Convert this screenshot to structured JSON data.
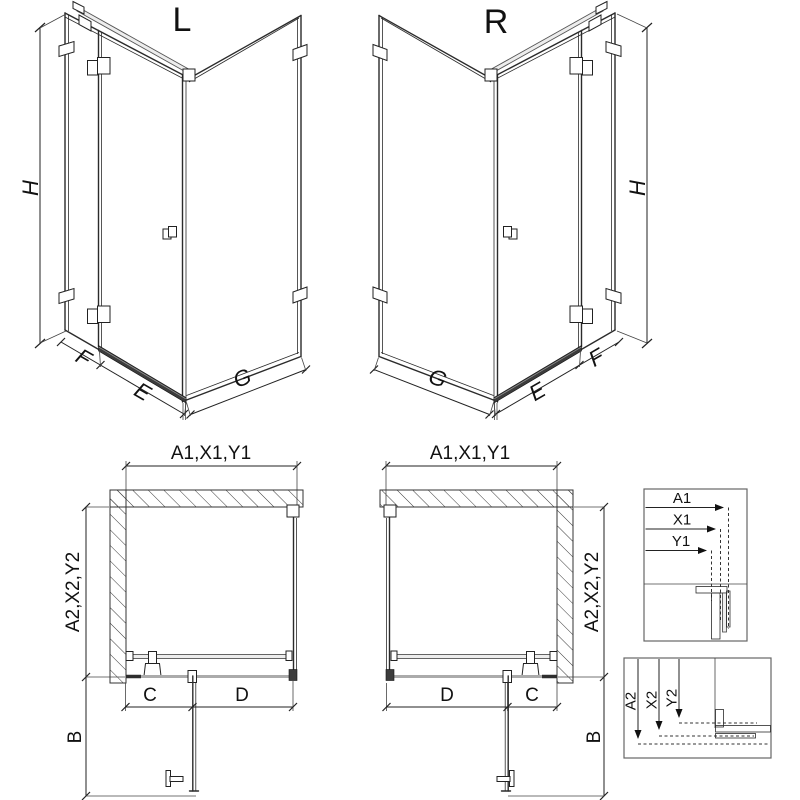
{
  "colors": {
    "background": "#ffffff",
    "line": "#2b2b2b",
    "dimension": "#222222",
    "sill_gray": "#ababab",
    "hardware_dark": "#3c3c3c"
  },
  "iso_left": {
    "title": "L",
    "height_label": "H",
    "panel_label": "F",
    "door_label": "E",
    "side_label": "G"
  },
  "iso_right": {
    "title": "R",
    "height_label": "H",
    "panel_label": "F",
    "door_label": "E",
    "side_label": "G"
  },
  "plan_left": {
    "width_label": "A1,X1,Y1",
    "depth_label": "A2,X2,Y2",
    "fixed_label": "C",
    "door_label": "D",
    "swing_label": "B"
  },
  "plan_right": {
    "width_label": "A1,X1,Y1",
    "depth_label": "A2,X2,Y2",
    "fixed_label": "C",
    "door_label": "D",
    "swing_label": "B"
  },
  "detail_width": {
    "a1": "A1",
    "x1": "X1",
    "y1": "Y1"
  },
  "detail_depth": {
    "a2": "A2",
    "x2": "X2",
    "y2": "Y2"
  }
}
